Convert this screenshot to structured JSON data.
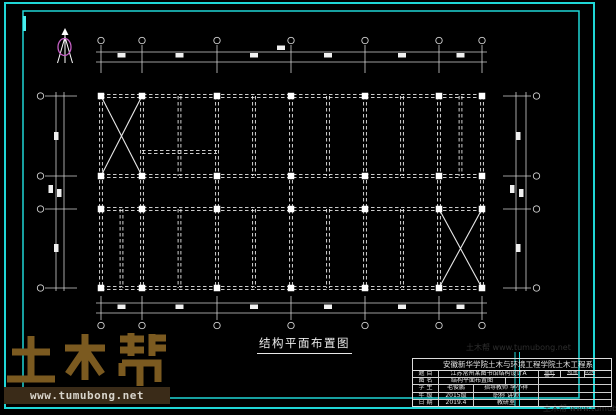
{
  "colors": {
    "background": "#000000",
    "frame_cyan": "#1fd6d6",
    "frame_cyan_bright": "#49eded",
    "line_white": "#e8e8e8",
    "dim_gray": "#d0d0d0",
    "north_magenta": "#c55fc5",
    "watermark_brown": "#7b5a20",
    "watermark_bar_bg": "#3a2b18",
    "watermark_bar_text": "#d8d4cb"
  },
  "frames": {
    "outer": {
      "x": 5,
      "y": 3,
      "w": 589,
      "h": 405
    },
    "inner": {
      "x": 23,
      "y": 11,
      "w": 556,
      "h": 387
    },
    "extra_verticals_x": [
      515,
      519.5
    ],
    "extra_verticals_y": [
      352,
      407
    ],
    "accent_bar": {
      "x": 24.5,
      "y1": 16,
      "y2": 31
    }
  },
  "plan": {
    "cols": [
      101,
      142,
      217,
      291,
      365,
      439,
      482
    ],
    "rows": [
      96,
      176,
      209,
      288
    ],
    "secondary_top_x": [
      179.5,
      254,
      328,
      402,
      460.5
    ],
    "secondary_bottom_x": [
      121.5,
      179.5,
      254,
      328,
      402
    ],
    "stair_beam": {
      "x1": 142,
      "x2": 217,
      "y": 152
    },
    "braces": [
      [
        101,
        96,
        142,
        176
      ],
      [
        142,
        96,
        101,
        176
      ],
      [
        439,
        209,
        482,
        288
      ],
      [
        482,
        209,
        439,
        288
      ]
    ],
    "column_size": 6.5
  },
  "dims": {
    "top": {
      "lines_y": [
        52,
        62
      ],
      "span_x": [
        96,
        487
      ],
      "tick_y": [
        45,
        73
      ],
      "circle_y": 40.5,
      "blobs": [
        [
          117.5,
          53
        ],
        [
          175.5,
          53
        ],
        [
          250,
          53
        ],
        [
          324,
          53
        ],
        [
          398,
          53
        ],
        [
          456.5,
          53
        ],
        [
          277,
          45.5
        ]
      ]
    },
    "bottom": {
      "lines_y": [
        303,
        313
      ],
      "span_x": [
        96,
        487
      ],
      "tick_y": [
        296,
        320
      ],
      "circle_y": 325.5,
      "blobs": [
        [
          117.5,
          304.5
        ],
        [
          175.5,
          304.5
        ],
        [
          250,
          304.5
        ],
        [
          324,
          304.5
        ],
        [
          398,
          304.5
        ],
        [
          456.5,
          304.5
        ]
      ]
    },
    "left": {
      "lines_x": [
        56,
        64
      ],
      "span_y": [
        92,
        291
      ],
      "tick_x": [
        45,
        77
      ],
      "circle_x": 40.5,
      "blobs": [
        [
          54,
          132
        ],
        [
          48.5,
          185
        ],
        [
          57,
          189
        ],
        [
          54,
          244
        ]
      ]
    },
    "right": {
      "lines_x": [
        516,
        526
      ],
      "span_y": [
        92,
        291
      ],
      "tick_x": [
        503,
        531
      ],
      "circle_x": 536.5,
      "blobs": [
        [
          516,
          132
        ],
        [
          510,
          185
        ],
        [
          519,
          189
        ],
        [
          516,
          244
        ]
      ]
    },
    "circle_r": 3.2,
    "blob_h": 4.5,
    "blob_w": 8
  },
  "north_arrow": {
    "cx": 65,
    "top": 28,
    "bottom": 63,
    "leg_spread": 7.5,
    "ellipse": {
      "cy": 47,
      "rx": 6.5,
      "ry": 8.5
    }
  },
  "drawing_title": {
    "text": "结构平面布置图"
  },
  "watermark": {
    "brand": "土木帮",
    "url": "www.tumubong.net",
    "faint_marks": [
      {
        "text": "土木帮 www.tumubong.net",
        "x": 466,
        "y": 342
      },
      {
        "text": "土木帮 www.tumubong.net",
        "x": 543,
        "y": 403
      }
    ]
  },
  "title_block": {
    "header": "安徽新华学院土木与环境工程学院土木工程系",
    "rows": [
      {
        "label": "题 目",
        "value": "江苏常州某图书馆结构设计A"
      },
      {
        "label": "图 名",
        "value": "结构平面布置图"
      },
      {
        "label": "学 生",
        "value": "毛俊鹏",
        "extra": "指导教师 李小祥"
      },
      {
        "label": "年 级",
        "value": "2015级",
        "extra": "职称 讲师"
      },
      {
        "label": "日 期",
        "value": "2019.4",
        "extra": "教研室"
      }
    ],
    "mini": {
      "a": "图别",
      "b": "图号",
      "a_val": "结施",
      "b_val": "",
      "c": "比例",
      "c_val": ""
    }
  }
}
